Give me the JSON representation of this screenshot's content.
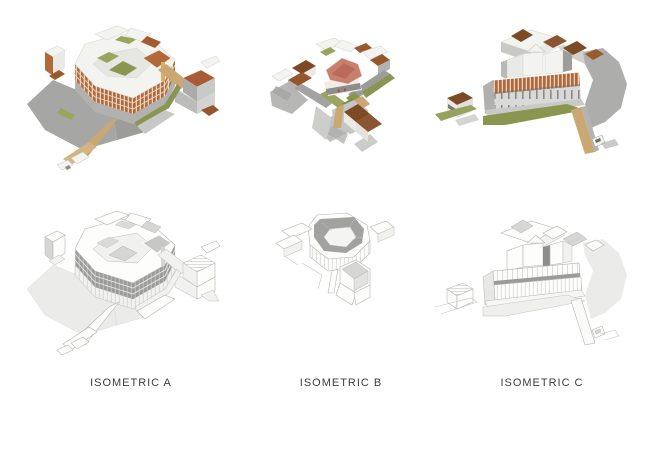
{
  "captions": [
    {
      "label": "ISOMETRIC A"
    },
    {
      "label": "ISOMETRIC B"
    },
    {
      "label": "ISOMETRIC C"
    }
  ],
  "palette": {
    "background": "#ffffff",
    "terracotta_facade": "#b2693a",
    "roof_brown_dark": "#7d4a26",
    "roof_brown_mid": "#94572c",
    "roof_salmon": "#c97f6e",
    "olive_green": "#8a9650",
    "tan_walkway": "#c9a873",
    "shadow_gray": "#a6a6a4",
    "white_building": "#f3f3f0",
    "wireframe_line": "#b5b5b3",
    "wireframe_shade": "#9b9b99",
    "caption_text": "#3d3d3d"
  }
}
